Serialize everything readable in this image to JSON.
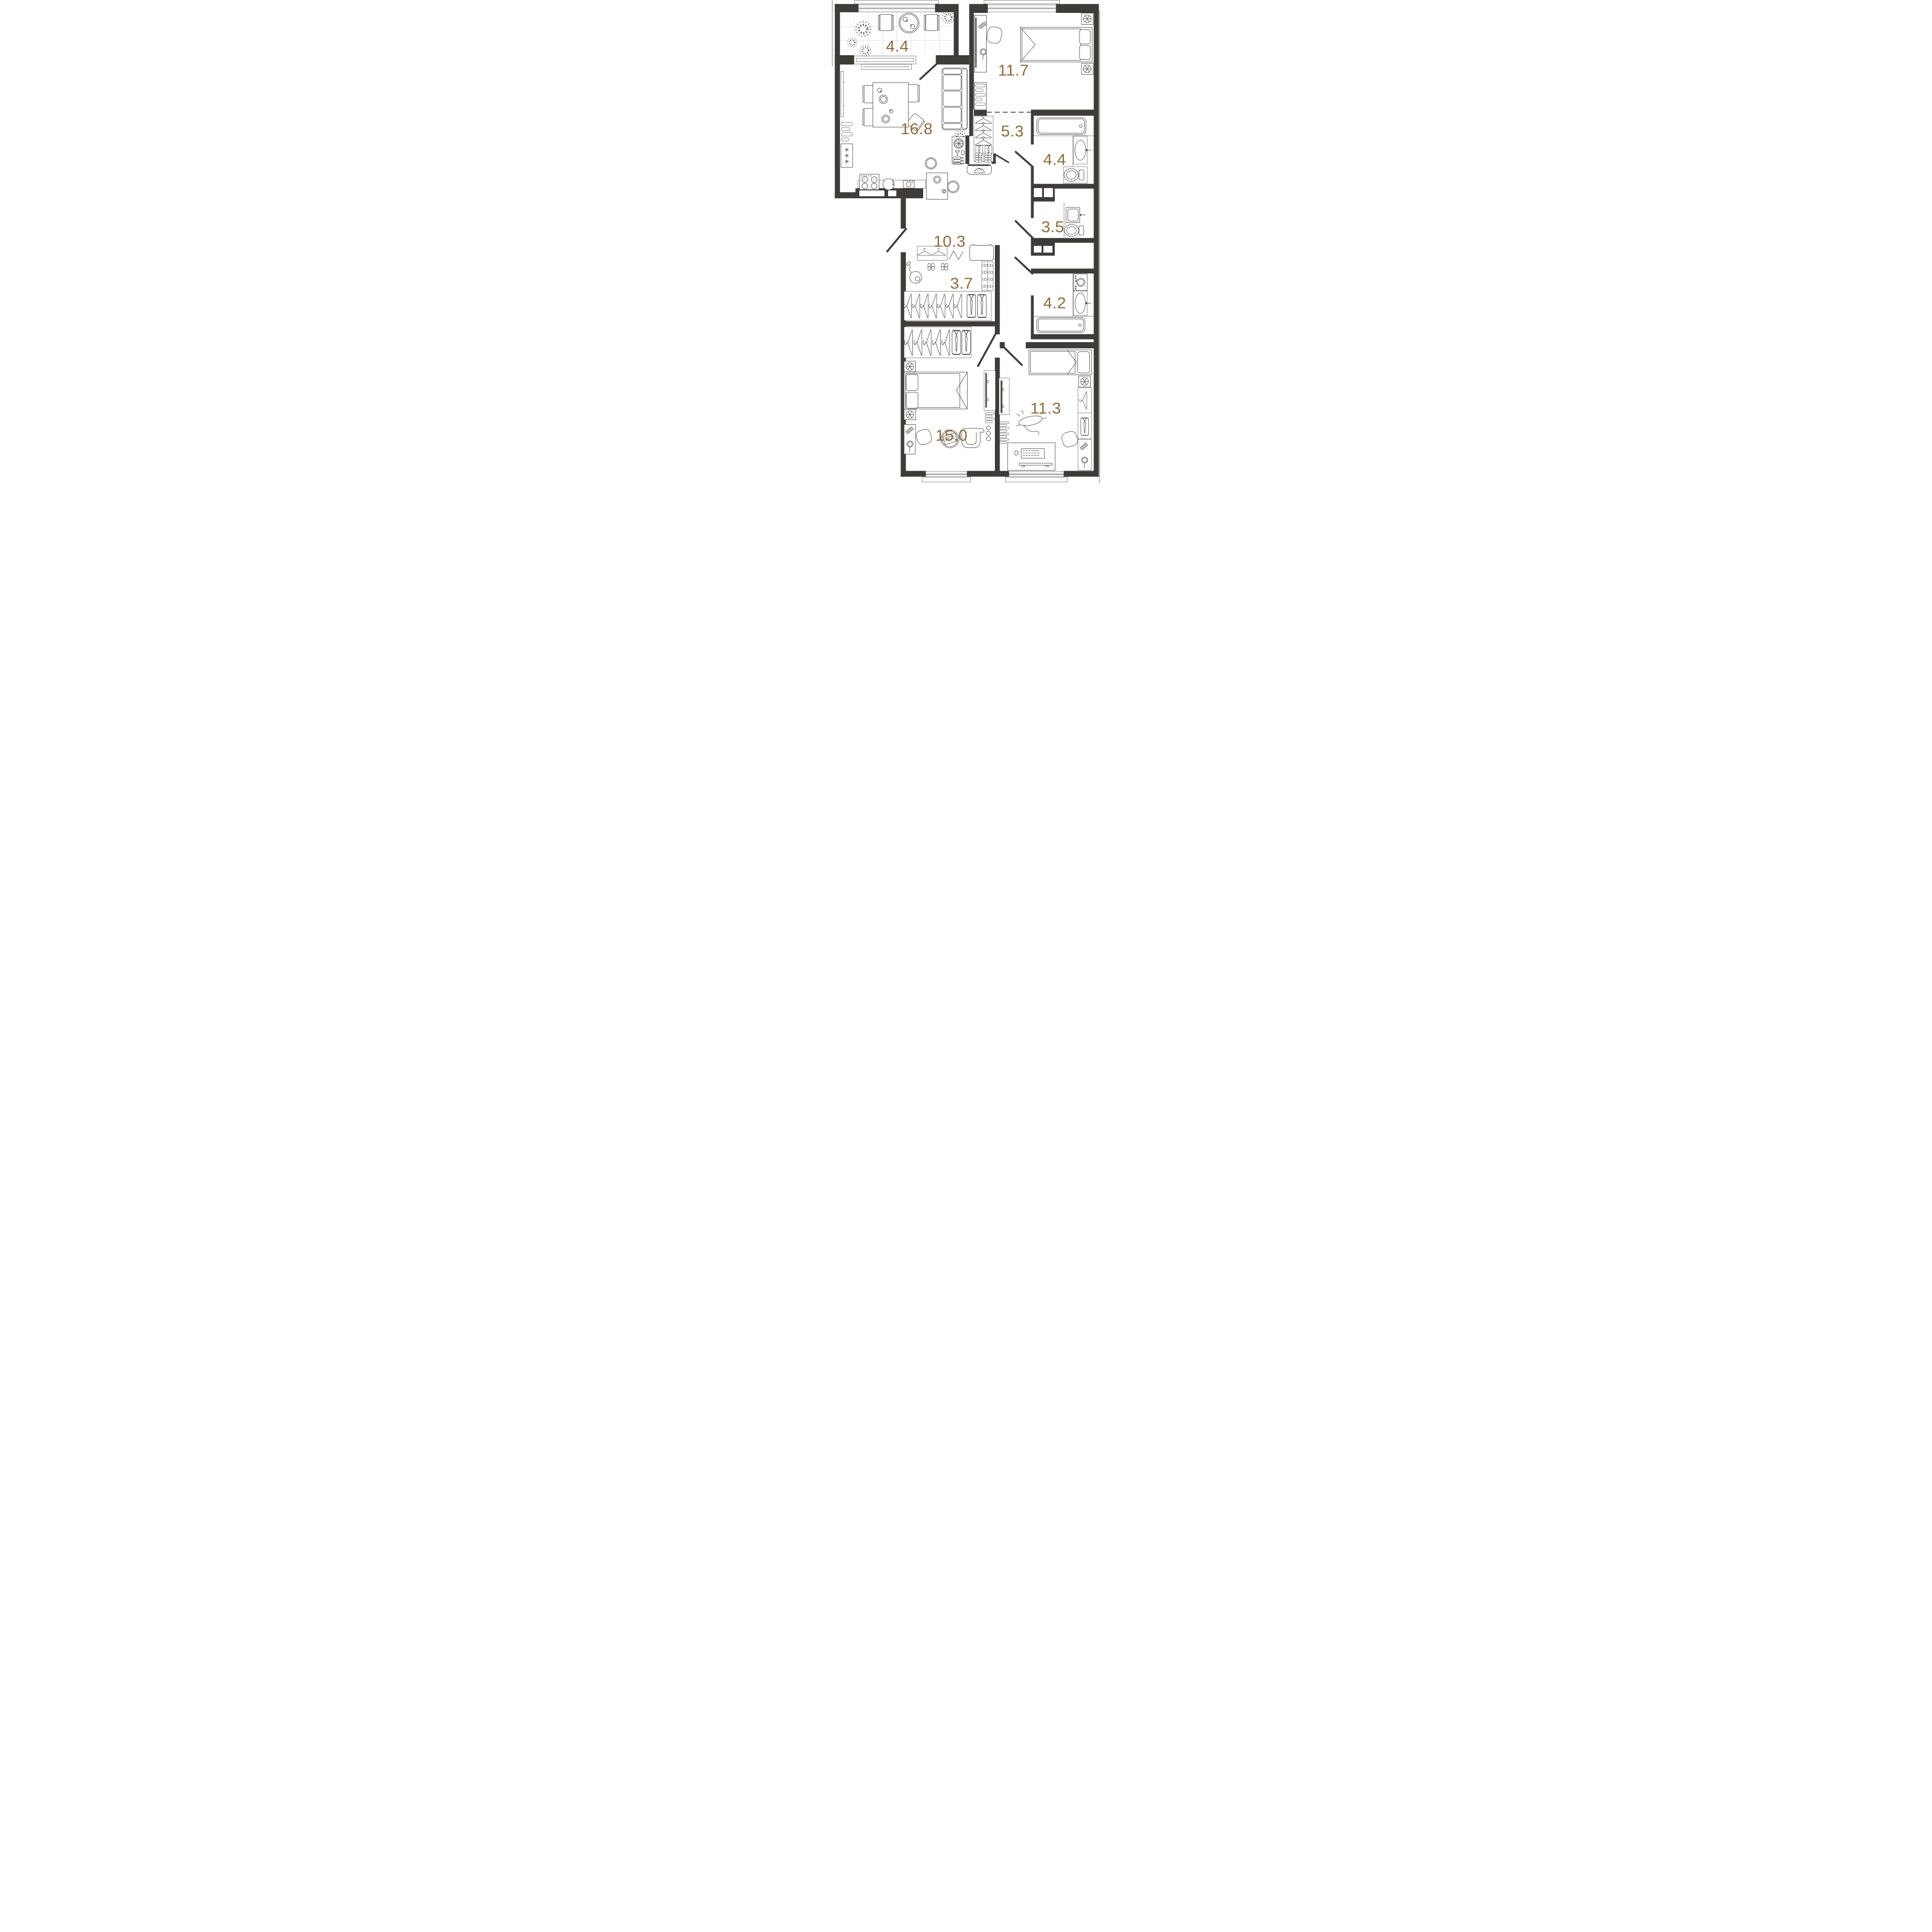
{
  "plan": {
    "kind": "apartment-floor-plan",
    "units": "m2"
  },
  "palette": {
    "bg": "#FFFFFF",
    "wall": "#3E3C39",
    "line": "#4B4946",
    "label": "#8C6D3F",
    "grid": "#C9C7C4"
  },
  "rooms": [
    {
      "id": "balcony",
      "area": "4.4"
    },
    {
      "id": "bedroom-top",
      "area": "11.7"
    },
    {
      "id": "kitchen-living",
      "area": "16.8"
    },
    {
      "id": "hallway",
      "area": "5.3"
    },
    {
      "id": "bathroom-top",
      "area": "4.4"
    },
    {
      "id": "bathroom-middle",
      "area": "3.5"
    },
    {
      "id": "corridor",
      "area": "10.3"
    },
    {
      "id": "walk-in-closet",
      "area": "3.7"
    },
    {
      "id": "bathroom-bottom",
      "area": "4.2"
    },
    {
      "id": "bedroom-left",
      "area": "15.0"
    },
    {
      "id": "bedroom-right",
      "area": "11.3"
    }
  ]
}
